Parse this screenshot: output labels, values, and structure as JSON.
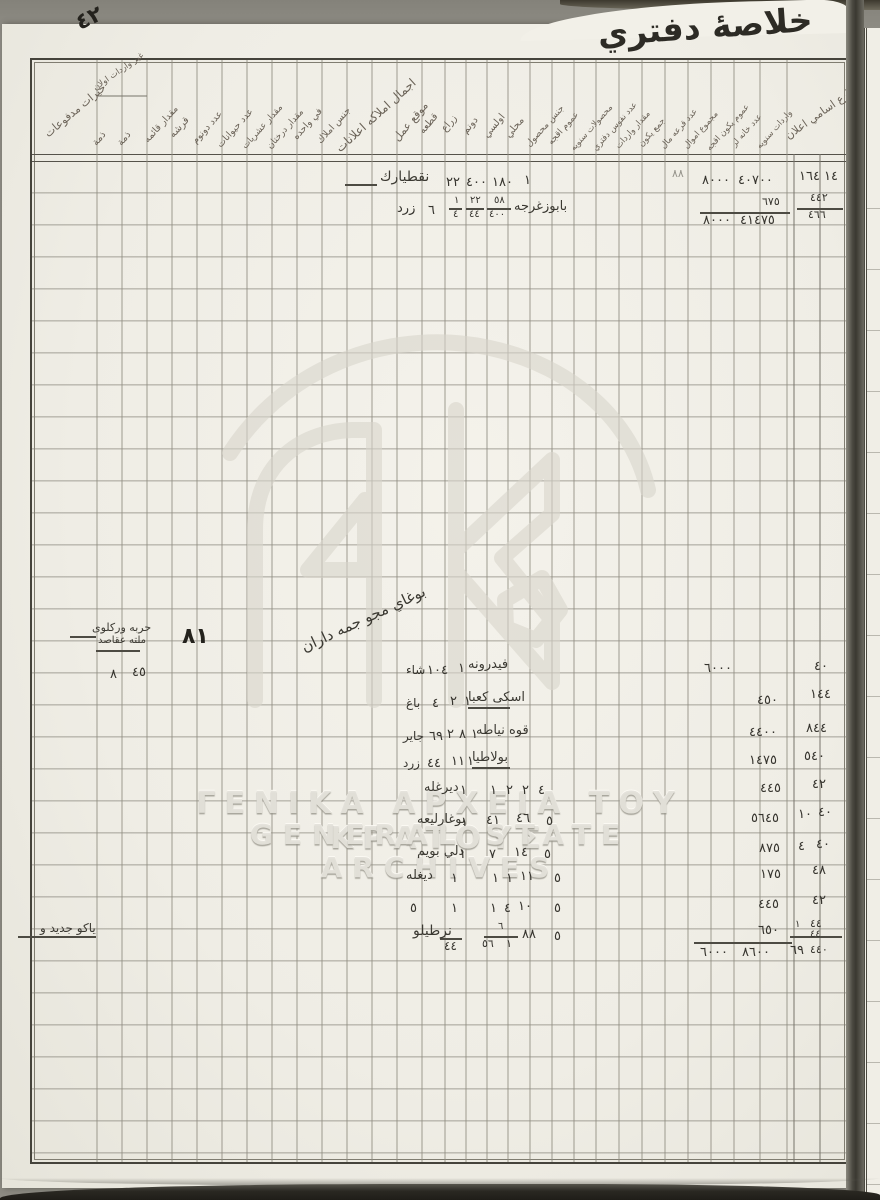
{
  "page": {
    "title": "خلاصۀ دفتري",
    "corner_mark": "٤٢",
    "big_page_number": "٨١",
    "next_page_mark": "٨"
  },
  "watermark": {
    "monogram": "AK",
    "line_greek": "ΓΕΝΙΚΑ ΑΡΧΕΙΑ ΤΟΥ ΚΡΑΤΟΥΣ",
    "line_latin": "GENERAL STATE ARCHIVES"
  },
  "table": {
    "headers": [
      {
        "label": "خيرات مدفوعات",
        "x": 50,
        "y": 128,
        "rot": -40,
        "fs": 11
      },
      {
        "label": "غير واردات اولان",
        "x": 97,
        "y": 84,
        "rot": -35,
        "fs": 8.5
      },
      {
        "label": "ذمة",
        "x": 99,
        "y": 138,
        "rot": -50,
        "fs": 10
      },
      {
        "label": "ذمة",
        "x": 124,
        "y": 138,
        "rot": -50,
        "fs": 10
      },
      {
        "label": "مقدار قائمه",
        "x": 150,
        "y": 135,
        "rot": -48,
        "fs": 9.5
      },
      {
        "label": "قرشه",
        "x": 176,
        "y": 130,
        "rot": -48,
        "fs": 10
      },
      {
        "label": "عدد دونوم",
        "x": 198,
        "y": 136,
        "rot": -48,
        "fs": 9.5
      },
      {
        "label": "عدد حيوانات",
        "x": 223,
        "y": 140,
        "rot": -48,
        "fs": 9.5
      },
      {
        "label": "مقدار عشريات",
        "x": 248,
        "y": 142,
        "rot": -48,
        "fs": 9
      },
      {
        "label": "مقدار درختان",
        "x": 273,
        "y": 142,
        "rot": -48,
        "fs": 9
      },
      {
        "label": "في واحده",
        "x": 299,
        "y": 132,
        "rot": -48,
        "fs": 9.5
      },
      {
        "label": "جنس املاك",
        "x": 323,
        "y": 136,
        "rot": -48,
        "fs": 9.5
      },
      {
        "label": "اجمال املاكه اعلانات",
        "x": 342,
        "y": 142,
        "rot": -42,
        "fs": 12
      },
      {
        "label": "موقع عمل",
        "x": 400,
        "y": 132,
        "rot": -50,
        "fs": 11
      },
      {
        "label": "قطعه",
        "x": 426,
        "y": 126,
        "rot": -50,
        "fs": 10
      },
      {
        "label": "زراع",
        "x": 448,
        "y": 124,
        "rot": -50,
        "fs": 10
      },
      {
        "label": "دونم",
        "x": 469,
        "y": 126,
        "rot": -50,
        "fs": 10
      },
      {
        "label": "اولسي",
        "x": 490,
        "y": 130,
        "rot": -50,
        "fs": 10
      },
      {
        "label": "محلي",
        "x": 512,
        "y": 130,
        "rot": -50,
        "fs": 10
      },
      {
        "label": "جنس محصول",
        "x": 532,
        "y": 140,
        "rot": -48,
        "fs": 9
      },
      {
        "label": "عموم اقجه",
        "x": 554,
        "y": 138,
        "rot": -48,
        "fs": 9
      },
      {
        "label": "محصولات سنويه",
        "x": 576,
        "y": 144,
        "rot": -48,
        "fs": 8.5
      },
      {
        "label": "عدد نفوس دفتري",
        "x": 598,
        "y": 144,
        "rot": -48,
        "fs": 8.5
      },
      {
        "label": "مقدار واردات",
        "x": 621,
        "y": 142,
        "rot": -48,
        "fs": 8.5
      },
      {
        "label": "جمع يكون",
        "x": 644,
        "y": 140,
        "rot": -48,
        "fs": 8.5
      },
      {
        "label": "عدد قرعه مال",
        "x": 666,
        "y": 142,
        "rot": -48,
        "fs": 8.5
      },
      {
        "label": "مجموع اموال",
        "x": 689,
        "y": 142,
        "rot": -48,
        "fs": 8.5
      },
      {
        "label": "عموم يكون اقجه",
        "x": 712,
        "y": 144,
        "rot": -48,
        "fs": 8.5
      },
      {
        "label": "عدد خانه لر",
        "x": 737,
        "y": 140,
        "rot": -48,
        "fs": 8.5
      },
      {
        "label": "واردات سنويه",
        "x": 762,
        "y": 142,
        "rot": -48,
        "fs": 8.5
      },
      {
        "label": "قرئ و مزارع اسامي اعلان",
        "x": 790,
        "y": 130,
        "rot": -35,
        "fs": 11
      }
    ],
    "entries": [
      {
        "t": "٤٢",
        "x": 76,
        "y": 8,
        "fs": 22,
        "cls": "ink",
        "rot": -25
      },
      {
        "t": "٨",
        "x": 868,
        "y": 50,
        "fs": 11,
        "cls": "faint"
      },
      {
        "t": "نقطيارك",
        "x": 380,
        "y": 170,
        "fs": 14,
        "cls": "hw"
      },
      {
        "t": "٢٢",
        "x": 446,
        "y": 176
      },
      {
        "t": "٤٠٠",
        "x": 466,
        "y": 176
      },
      {
        "t": "١٨٠",
        "x": 492,
        "y": 176
      },
      {
        "t": "١",
        "x": 524,
        "y": 174
      },
      {
        "t": "٨٠٠٠",
        "x": 702,
        "y": 174
      },
      {
        "t": "٤٠٧٠٠",
        "x": 738,
        "y": 174
      },
      {
        "t": "١٦٤",
        "x": 799,
        "y": 170
      },
      {
        "t": "١٤",
        "x": 824,
        "y": 170
      },
      {
        "t": "٨٨",
        "x": 672,
        "y": 168,
        "fs": 11,
        "cls": "faint"
      },
      {
        "t": "زرد",
        "x": 397,
        "y": 202
      },
      {
        "t": "٦",
        "x": 428,
        "y": 204
      },
      {
        "t": "١",
        "x": 454,
        "y": 196,
        "fs": 10
      },
      {
        "t": "٤",
        "x": 453,
        "y": 210,
        "fs": 10
      },
      {
        "t": "٢٢",
        "x": 470,
        "y": 196,
        "fs": 10
      },
      {
        "t": "٤٤",
        "x": 469,
        "y": 210,
        "fs": 10
      },
      {
        "t": "٥٨",
        "x": 494,
        "y": 196,
        "fs": 10
      },
      {
        "t": "٤٠٠",
        "x": 489,
        "y": 210,
        "fs": 10
      },
      {
        "t": "بابوزغرجه",
        "x": 514,
        "y": 200,
        "cls": "hw"
      },
      {
        "t": "٦٧٥",
        "x": 762,
        "y": 196,
        "fs": 11
      },
      {
        "t": "٨٠٠٠",
        "x": 703,
        "y": 214
      },
      {
        "t": "٤١٤٧٥",
        "x": 740,
        "y": 214
      },
      {
        "t": "٤٤٢",
        "x": 810,
        "y": 192,
        "fs": 11
      },
      {
        "t": "٤٦٦",
        "x": 808,
        "y": 209,
        "fs": 11
      },
      {
        "t": "٨١",
        "x": 182,
        "y": 626,
        "fs": 22,
        "cls": "ink"
      },
      {
        "t": "حربه وركلوى",
        "x": 92,
        "y": 622,
        "fs": 11,
        "cls": "hw"
      },
      {
        "t": "ملته عقاصد",
        "x": 98,
        "y": 636,
        "fs": 10,
        "cls": "hw"
      },
      {
        "t": "٨",
        "x": 110,
        "y": 668
      },
      {
        "t": "٤٥",
        "x": 132,
        "y": 666
      },
      {
        "t": "بوغاي مجو جمه داران",
        "x": 296,
        "y": 612,
        "fs": 15,
        "cls": "hw",
        "rot": -25
      },
      {
        "t": "شاء",
        "x": 406,
        "y": 664,
        "fs": 12
      },
      {
        "t": "١٠٤",
        "x": 427,
        "y": 664
      },
      {
        "t": "١",
        "x": 458,
        "y": 662
      },
      {
        "t": "فيدرونه",
        "x": 468,
        "y": 658,
        "cls": "hw"
      },
      {
        "t": "٦٠٠٠",
        "x": 704,
        "y": 662
      },
      {
        "t": "٤٠",
        "x": 814,
        "y": 660
      },
      {
        "t": "باغ",
        "x": 406,
        "y": 697,
        "fs": 12
      },
      {
        "t": "٤",
        "x": 432,
        "y": 697
      },
      {
        "t": "٢",
        "x": 450,
        "y": 695
      },
      {
        "t": "١",
        "x": 464,
        "y": 695
      },
      {
        "t": "اسكى كعبا",
        "x": 468,
        "y": 691,
        "cls": "hw"
      },
      {
        "t": "٤٥٠",
        "x": 757,
        "y": 694
      },
      {
        "t": "١٤٤",
        "x": 810,
        "y": 688
      },
      {
        "t": "جاير",
        "x": 403,
        "y": 730,
        "fs": 12
      },
      {
        "t": "٦٩",
        "x": 429,
        "y": 730
      },
      {
        "t": "٢",
        "x": 447,
        "y": 728
      },
      {
        "t": "٨",
        "x": 459,
        "y": 728
      },
      {
        "t": "١",
        "x": 471,
        "y": 728
      },
      {
        "t": "قوه نياطه",
        "x": 476,
        "y": 724,
        "cls": "hw"
      },
      {
        "t": "٤٤٠٠",
        "x": 749,
        "y": 726
      },
      {
        "t": "٨٤٤",
        "x": 806,
        "y": 722
      },
      {
        "t": "زرد",
        "x": 403,
        "y": 757,
        "fs": 12
      },
      {
        "t": "٤٤",
        "x": 427,
        "y": 757
      },
      {
        "t": "١١",
        "x": 451,
        "y": 755
      },
      {
        "t": "١",
        "x": 467,
        "y": 755
      },
      {
        "t": "بولاطيا",
        "x": 472,
        "y": 751,
        "cls": "hw"
      },
      {
        "t": "١٤٧٥",
        "x": 749,
        "y": 754
      },
      {
        "t": "٥٤٠",
        "x": 804,
        "y": 750
      },
      {
        "t": "ديرغله",
        "x": 424,
        "y": 781,
        "cls": "hw"
      },
      {
        "t": "١",
        "x": 460,
        "y": 784
      },
      {
        "t": "١",
        "x": 490,
        "y": 784
      },
      {
        "t": "٢",
        "x": 506,
        "y": 784
      },
      {
        "t": "٢",
        "x": 522,
        "y": 784
      },
      {
        "t": "٤",
        "x": 538,
        "y": 784
      },
      {
        "t": "٤٤٥",
        "x": 760,
        "y": 782
      },
      {
        "t": "٤٢",
        "x": 812,
        "y": 778
      },
      {
        "t": "بوغارليعه",
        "x": 417,
        "y": 813,
        "cls": "hw"
      },
      {
        "t": "١",
        "x": 461,
        "y": 816
      },
      {
        "t": "٤١",
        "x": 486,
        "y": 814
      },
      {
        "t": "٤٦",
        "x": 516,
        "y": 812
      },
      {
        "t": "٥",
        "x": 546,
        "y": 815
      },
      {
        "t": "٥٦٤٥",
        "x": 751,
        "y": 812
      },
      {
        "t": "١٠",
        "x": 798,
        "y": 808
      },
      {
        "t": "٤٠",
        "x": 818,
        "y": 806
      },
      {
        "t": "دلي بويم",
        "x": 417,
        "y": 845,
        "cls": "hw"
      },
      {
        "t": "١",
        "x": 459,
        "y": 848
      },
      {
        "t": "٧",
        "x": 489,
        "y": 848
      },
      {
        "t": "١٤",
        "x": 514,
        "y": 846
      },
      {
        "t": "٥",
        "x": 544,
        "y": 848
      },
      {
        "t": "٨٧٥",
        "x": 759,
        "y": 842
      },
      {
        "t": "٤",
        "x": 798,
        "y": 840
      },
      {
        "t": "٤٠",
        "x": 816,
        "y": 838
      },
      {
        "t": "ديغله",
        "x": 406,
        "y": 869,
        "cls": "hw"
      },
      {
        "t": "١",
        "x": 451,
        "y": 872
      },
      {
        "t": "١",
        "x": 492,
        "y": 872
      },
      {
        "t": "١",
        "x": 506,
        "y": 872
      },
      {
        "t": "١١",
        "x": 520,
        "y": 870
      },
      {
        "t": "٥",
        "x": 554,
        "y": 872
      },
      {
        "t": "١٧٥",
        "x": 760,
        "y": 868
      },
      {
        "t": "٤٨",
        "x": 812,
        "y": 864
      },
      {
        "t": "٥",
        "x": 410,
        "y": 902
      },
      {
        "t": "١",
        "x": 451,
        "y": 902
      },
      {
        "t": "١",
        "x": 490,
        "y": 902
      },
      {
        "t": "٤",
        "x": 504,
        "y": 902
      },
      {
        "t": "١٠",
        "x": 518,
        "y": 900
      },
      {
        "t": "٥",
        "x": 554,
        "y": 902
      },
      {
        "t": "٤٤٥",
        "x": 758,
        "y": 898
      },
      {
        "t": "٤٢",
        "x": 812,
        "y": 894
      },
      {
        "t": "نرطيلو",
        "x": 413,
        "y": 924,
        "fs": 14,
        "cls": "hw"
      },
      {
        "t": "٤٤",
        "x": 444,
        "y": 940,
        "fs": 12
      },
      {
        "t": "٦",
        "x": 498,
        "y": 922,
        "fs": 10
      },
      {
        "t": "٥٦",
        "x": 482,
        "y": 938,
        "fs": 11
      },
      {
        "t": "١",
        "x": 506,
        "y": 938,
        "fs": 11
      },
      {
        "t": "٨٨",
        "x": 522,
        "y": 928
      },
      {
        "t": "٥",
        "x": 554,
        "y": 930
      },
      {
        "t": "٦٥٠",
        "x": 758,
        "y": 924
      },
      {
        "t": "٦٠٠٠",
        "x": 700,
        "y": 946
      },
      {
        "t": "٨٦٠٠",
        "x": 742,
        "y": 946
      },
      {
        "t": "١",
        "x": 795,
        "y": 920,
        "fs": 10
      },
      {
        "t": "٤٤",
        "x": 810,
        "y": 918,
        "fs": 11
      },
      {
        "t": "٤٤",
        "x": 810,
        "y": 930,
        "fs": 10
      },
      {
        "t": "٦٩",
        "x": 790,
        "y": 944
      },
      {
        "t": "٤٤٠",
        "x": 810,
        "y": 944,
        "fs": 11
      },
      {
        "t": "ياكو جديد و",
        "x": 40,
        "y": 922,
        "fs": 12,
        "cls": "hw"
      }
    ],
    "rules": [
      {
        "x": 345,
        "y": 184,
        "w": 32
      },
      {
        "x": 449,
        "y": 208,
        "w": 13
      },
      {
        "x": 466,
        "y": 208,
        "w": 18
      },
      {
        "x": 487,
        "y": 208,
        "w": 24
      },
      {
        "x": 700,
        "y": 212,
        "w": 90,
        "th": 2
      },
      {
        "x": 797,
        "y": 208,
        "w": 46,
        "th": 2
      },
      {
        "x": 70,
        "y": 636,
        "w": 26
      },
      {
        "x": 96,
        "y": 650,
        "w": 44
      },
      {
        "x": 468,
        "y": 707,
        "w": 42
      },
      {
        "x": 472,
        "y": 767,
        "w": 38
      },
      {
        "x": 440,
        "y": 938,
        "w": 22,
        "th": 2
      },
      {
        "x": 484,
        "y": 936,
        "w": 34,
        "th": 2
      },
      {
        "x": 694,
        "y": 942,
        "w": 98,
        "th": 2
      },
      {
        "x": 790,
        "y": 936,
        "w": 52,
        "th": 2
      },
      {
        "x": 18,
        "y": 936,
        "w": 78
      }
    ]
  }
}
